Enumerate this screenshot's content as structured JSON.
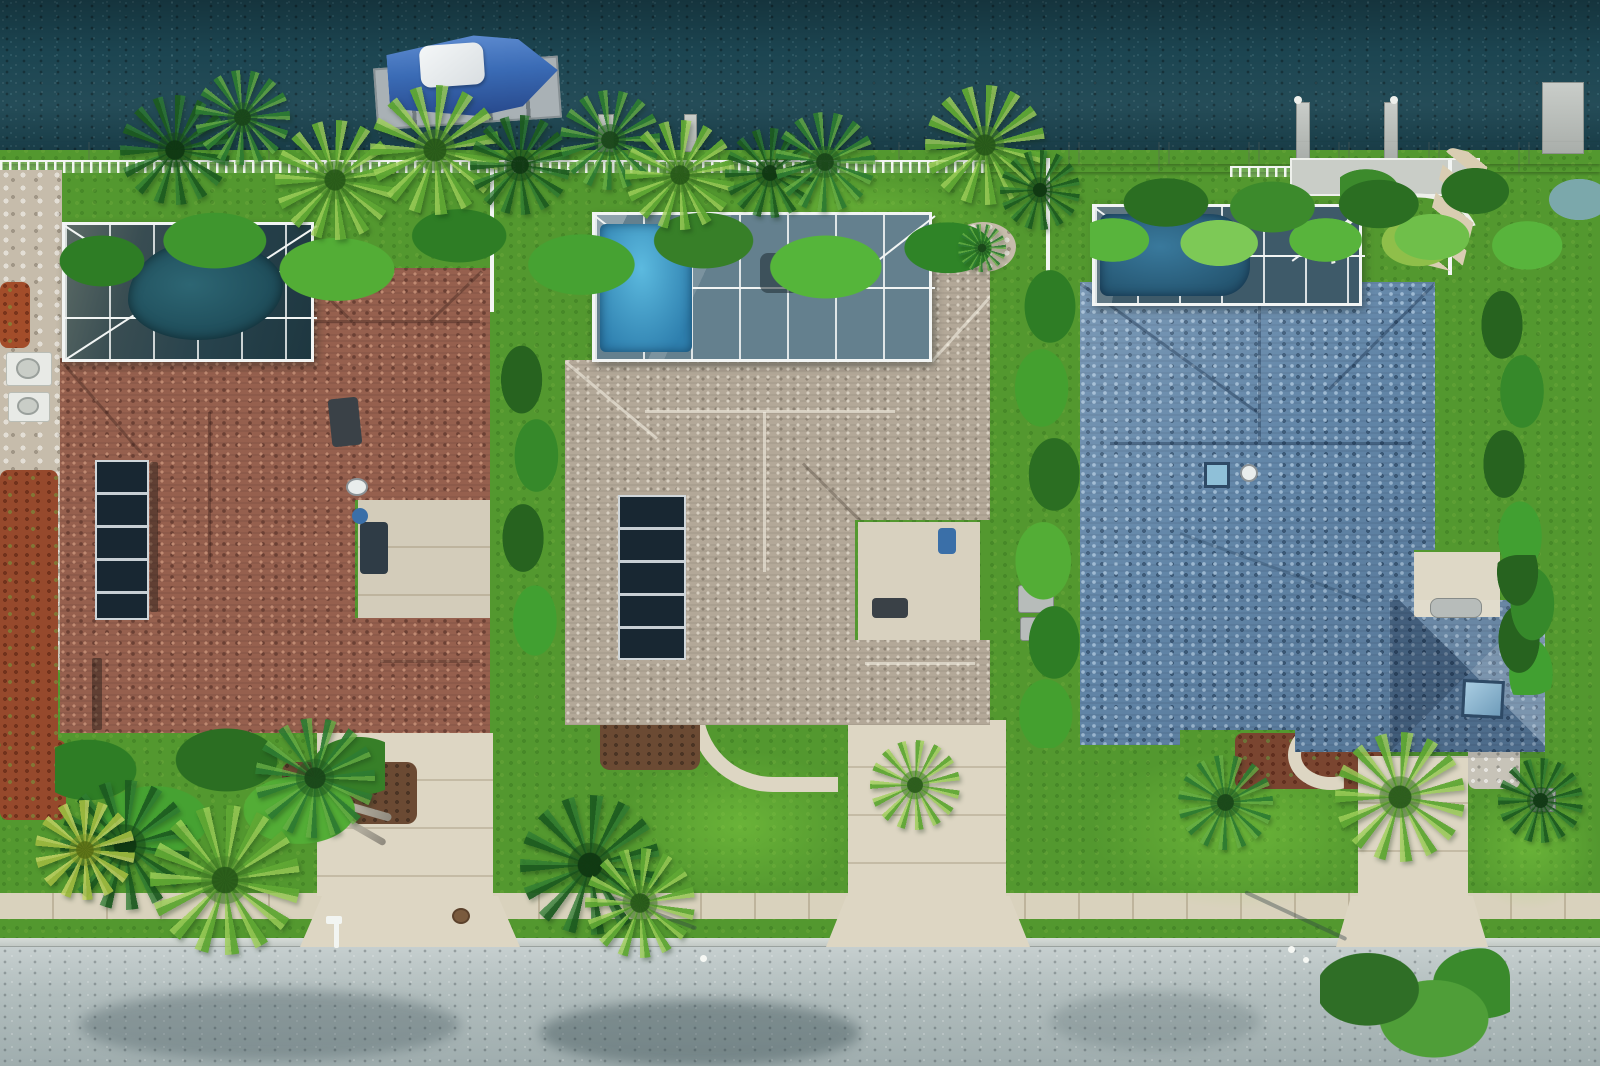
{
  "scene": {
    "label": "Aerial top-down drone photo of three waterfront homes on a canal with screened pools, a boat on a lift, tropical landscaping, driveways, sidewalk and street",
    "water_position": "top",
    "road_position": "bottom"
  },
  "objects": {
    "boat": {
      "label": "boat-on-lift",
      "hull_color": "#3a6bb5",
      "console_cover_color": "#edf1f3"
    },
    "seawall": {
      "label": "concrete-seawall-with-white-railing"
    },
    "houses": [
      {
        "label": "left-house-red-brown-tile-roof",
        "roof_color": "#96604e",
        "pool": "screened kidney pool",
        "solar_panels": 1
      },
      {
        "label": "middle-house-tan-shingle-roof",
        "roof_color": "#b3a898",
        "pool": "screened bright-blue pool",
        "solar_panels": 1
      },
      {
        "label": "right-house-blue-shingle-roof",
        "roof_color": "#6286a8",
        "pool": "screened lap pool",
        "solar_panels": 0
      }
    ]
  },
  "palette": {
    "water": "#1c4551",
    "grass": "#53982f",
    "concrete": "#ddd6c3",
    "frame-white": "#f2f5f4",
    "roof-left": "#96604e",
    "roof-left-dark": "#6b4034",
    "roof-left-light": "#c08a72",
    "roof-mid": "#b3a898",
    "roof-mid-dark": "#8c8273",
    "roof-mid-light": "#d8d0c2",
    "roof-right": "#6286a8",
    "roof-right-dark": "#3c5a78",
    "roof-right-light": "#9db9d2",
    "mulch": "#6b4a33",
    "mulch-red": "#96492c"
  }
}
